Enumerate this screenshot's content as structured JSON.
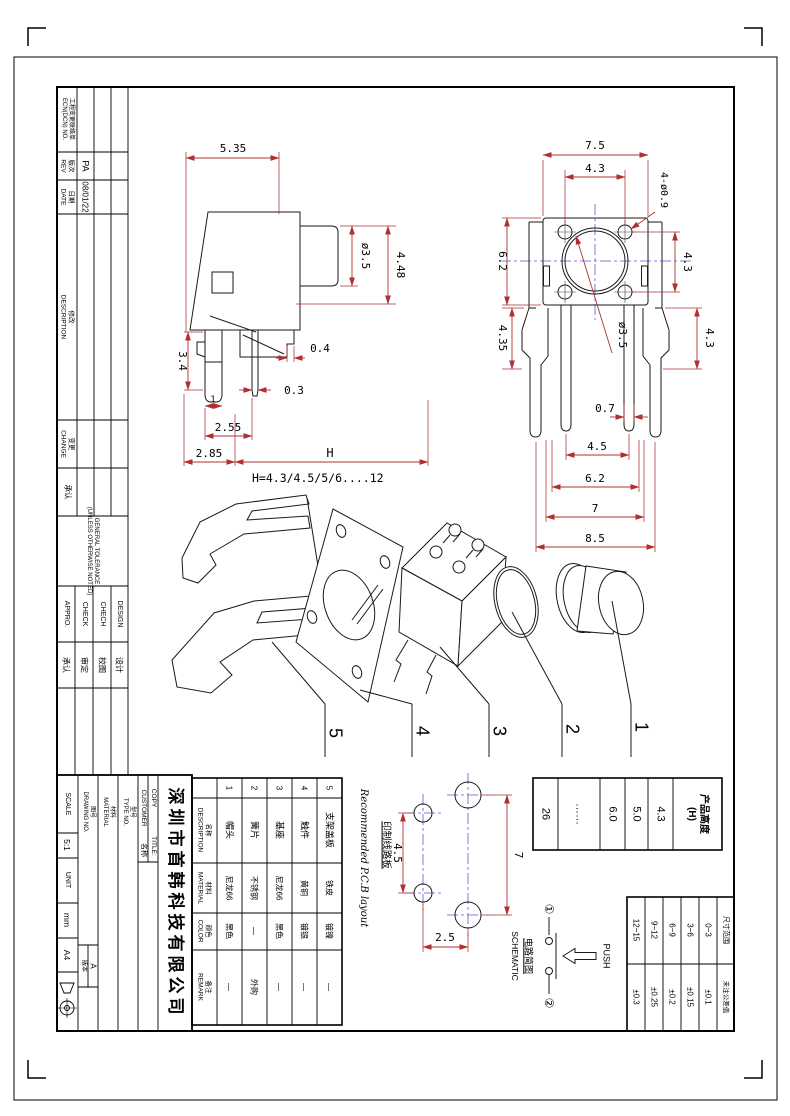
{
  "revision": {
    "header": {
      "cn": "工程变更联络单",
      "en": "ECN(DCN) NO."
    },
    "rev": {
      "cn": "版次",
      "en": "REV",
      "value": "PA"
    },
    "date": {
      "cn": "日期",
      "en": "DATE",
      "value": "08/01/22"
    },
    "desc": {
      "cn": "修改",
      "en": "DESCRIPTION"
    },
    "change": {
      "cn": "变更",
      "en": "CHANGE"
    },
    "approve": {
      "cn": "承认"
    }
  },
  "tolerance_note": {
    "l1": "GENERAL TOLERANCE",
    "l2": "(UNLESS OTHERWISE NOTED)"
  },
  "signoff": {
    "c1": {
      "en": "APPRO.",
      "cn": "承认"
    },
    "c2": {
      "en": "CHECK",
      "cn": "审定"
    },
    "c3": {
      "en": "CHECH",
      "cn": "校图"
    },
    "c4": {
      "en": "DESIGN",
      "cn": "设计"
    }
  },
  "titleblock": {
    "company": "深圳市首韩科技有限公司",
    "customer": "CUSTOMER",
    "copy": "COPY",
    "name_cn": "名称",
    "title": "TITLE:",
    "type_cn": "型号",
    "type_en": "TYPE NO.",
    "mat_cn": "材料",
    "mat_en": "MATERIAL",
    "dwg_cn": "图号",
    "dwg_en": "DRAWING NO.",
    "ver_label": "版本",
    "ver_value": "A",
    "scale_label": "SCALE",
    "scale": "5:1",
    "unit_label": "UNIT",
    "unit": "mm",
    "paper": "A4"
  },
  "parts": {
    "headers": {
      "name": {
        "cn": "名称",
        "en": "DESCRIPTION"
      },
      "mat": {
        "cn": "材料",
        "en": "MATERIAL"
      },
      "color": {
        "cn": "颜色",
        "en": "COLOR"
      },
      "remark": {
        "cn": "备注",
        "en": "REMARK"
      }
    },
    "rows": [
      {
        "no": "1",
        "name": "帽头",
        "mat": "尼龙66",
        "color": "黑色",
        "remark": "—"
      },
      {
        "no": "2",
        "name": "簧片",
        "mat": "不锈钢",
        "color": "—",
        "remark": "外购"
      },
      {
        "no": "3",
        "name": "基座",
        "mat": "尼龙66",
        "color": "黑色",
        "remark": "—"
      },
      {
        "no": "4",
        "name": "触件",
        "mat": "黄铜",
        "color": "镀银",
        "remark": "—"
      },
      {
        "no": "5",
        "name": "支架盖板",
        "mat": "铁皮",
        "color": "镀镍",
        "remark": "—"
      }
    ]
  },
  "height_table": {
    "h1": "产品高度",
    "h2": "(H)",
    "v1": "4.3",
    "v2": "5.0",
    "v3": "6.0",
    "v4": "……",
    "v5": "26"
  },
  "tol_table": {
    "range_label": "尺寸范围",
    "tol_label": "未注公差值",
    "r1": {
      "range": "0~3",
      "tol": "±0.1"
    },
    "r2": {
      "range": "3~6",
      "tol": "±0.15"
    },
    "r3": {
      "range": "6~9",
      "tol": "±0.2"
    },
    "r4": {
      "range": "9~12",
      "tol": "±0.25"
    },
    "r5": {
      "range": "12~15",
      "tol": "±0.3"
    }
  },
  "pcb": {
    "cn": "印制线路板",
    "en": "Recommended P.C.B layout",
    "pitch_a": "4.5",
    "pitch_b": "7",
    "pitch_c": "2.5"
  },
  "schematic": {
    "cn": "电路简图",
    "en": "SCHEMATIC",
    "push": "PUSH",
    "pin1": "①",
    "pin2": "②"
  },
  "side_view": {
    "w": "5.35",
    "stem": "ø3.5",
    "h448": "4.48",
    "step": "0.4",
    "leg": "3.4",
    "foot": "1",
    "pin": "0.3",
    "p255": "2.55",
    "p285": "2.85",
    "h": "H",
    "note": "H=4.3/4.5/5/6....12"
  },
  "top_view": {
    "w75": "7.5",
    "p43a": "4.3",
    "holes": "4-ø0.9",
    "h62": "6.2",
    "p43b": "4.3",
    "btn": "ø3.5",
    "d435": "4.35",
    "d43c": "4.3",
    "d07": "0.7",
    "d45": "4.5",
    "d62": "6.2",
    "d7": "7",
    "d85": "8.5"
  },
  "exploded": {
    "n1": "1",
    "n2": "2",
    "n3": "3",
    "n4": "4",
    "n5": "5"
  }
}
